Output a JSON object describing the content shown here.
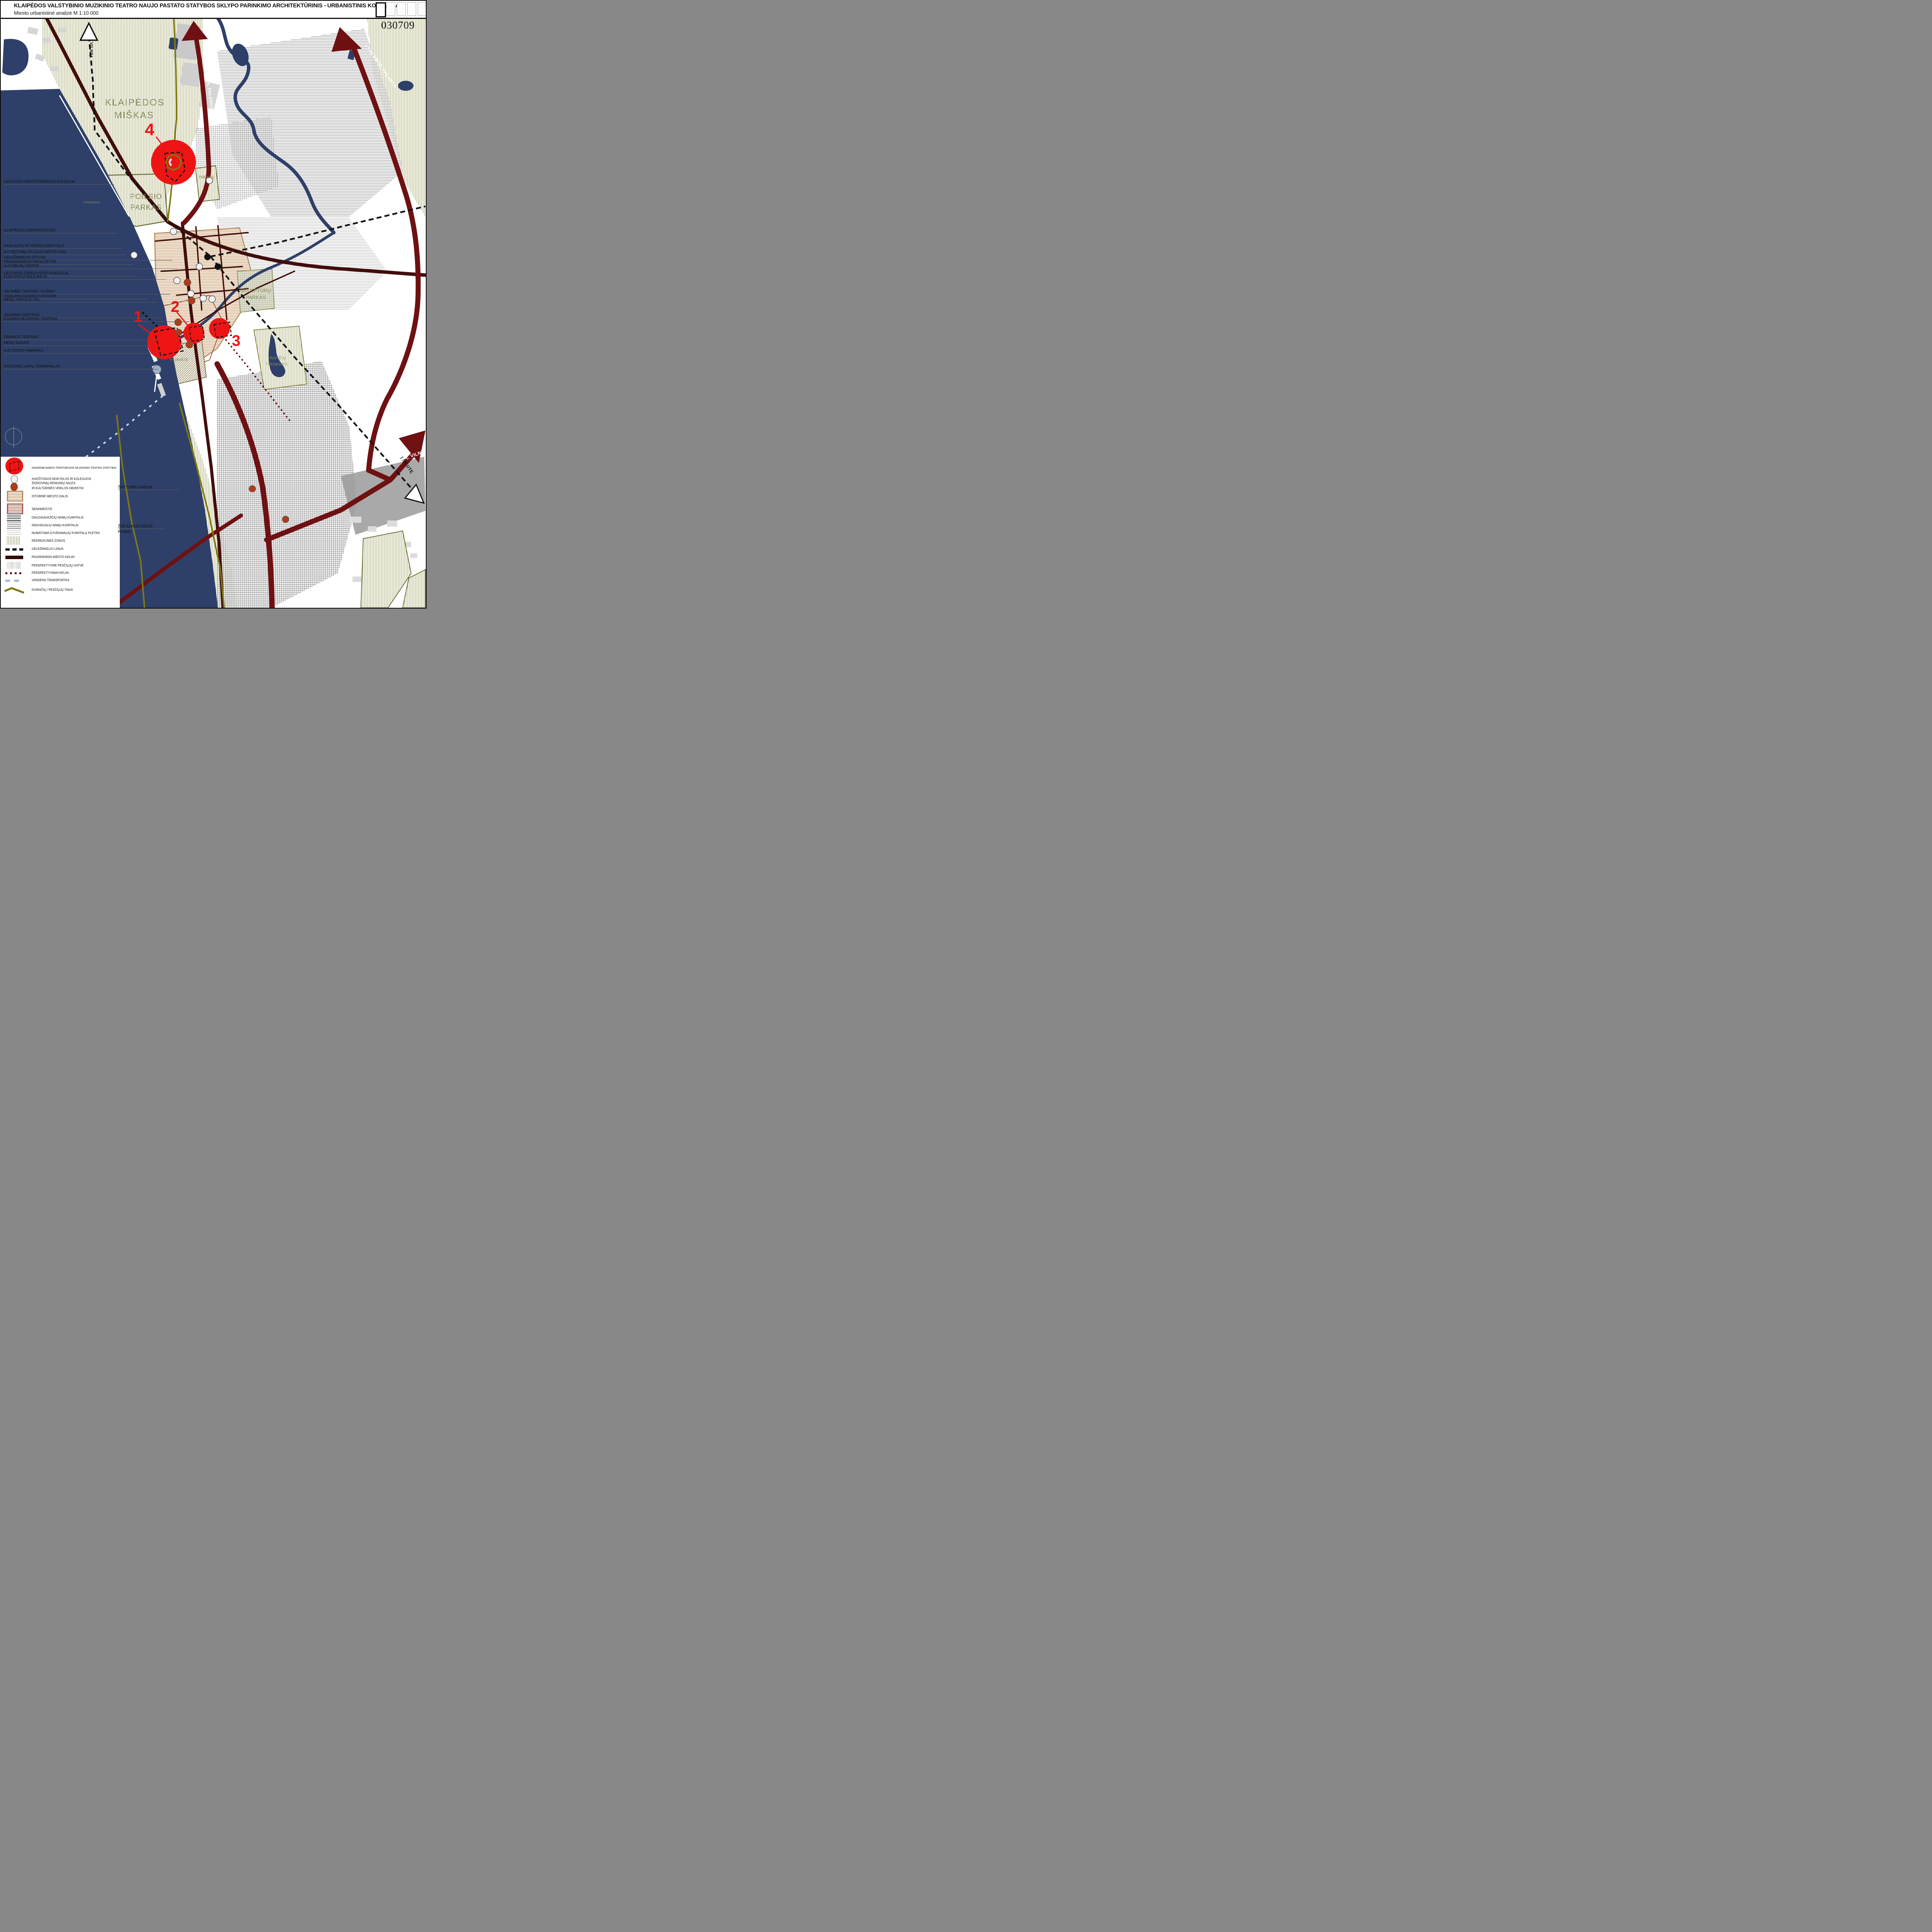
{
  "header": {
    "title": "KLAIPĖDOS VALSTYBINIO MUZIKINIO TEATRO NAUJO PASTATO STATYBOS SKLYPO PARINKIMO  ARCHITEKTŪRINIS - URBANISTINIS KONKURSAS",
    "subtitle": "Miesto urbanistinė analizė M 1:10 000",
    "sheet_code": "030709"
  },
  "compass_north": "Š",
  "road_labels": {
    "to_vilnius": "Į VILNIŲ",
    "to_kretinga_palanga_1": "Į KRETINGĄ, PALANGĄ",
    "to_kretinga_palanga_2": "Į KRETINGĄ, PALANGĄ",
    "to_kaunas_vilnius": "Į KAUNĄ, VILNIŲ",
    "to_silute": "Į ŠILUTĘ"
  },
  "area_labels": {
    "forest_1": "KLAIPĖDOS",
    "forest_2": "MIŠKAS",
    "poilsio_1": "POILSIO",
    "poilsio_2": "PARKAS",
    "trekas": "TREKAS",
    "stadionas": "STADIONAS",
    "skulpturu_1": "SKULPTŪRŲ",
    "skulpturu_2": "PARKAS",
    "trinyciu_1": "TRINYČIŲ",
    "trinyciu_2": "TVENKINYS",
    "piliaviete": "PILIAVIETĖ",
    "svyturio_arena": "ŠVYTURIO ARENA",
    "zveju_1": "ŽVEJŲ KULTŪROS",
    "zveju_2": "RŪMAI"
  },
  "site_markers": {
    "s1": "1",
    "s2": "2",
    "s3": "3",
    "s4": "4"
  },
  "left_labels": [
    "LIETUVOS KRIKŠČIONIŠKOJI KOLEGIJA",
    "KLAIPĖDOS UNIVERSITETAS",
    "PASLAUGŲ IR VERSLO MOKYKLA",
    "KU TĘSTINIŲ STUDIJU INSTITUTAS",
    "GELEŽINKELIO STOTIS",
    "PEDAGOGIKOS FAKULTETAS",
    "AUTOBUSŲ STOTIS",
    "LIETUVOS JŪREIVYSTĖS KOLEGIJA",
    "KONCERTŲ SALĖ 600 vt.",
    "JAUNIMO TEATRAS \"AUŠRA\"",
    "VIZALINIO DIZAINO KATEDRA",
    "MENŲ FAKULTETAS",
    "JAUNIMO CENTRAS",
    "ESAMAS MUZIKINIS TEATRAS",
    "DRAMOS TEATRAS",
    "MENŲ DOKAS",
    "KULTŪROS FABRIKAS",
    "KRUIZINIŲ LAIVŲ TERMIINALAS"
  ],
  "legend": {
    "rows": [
      {
        "label": "NAGRINĖJAMOS TERITORIJOS MUZIKINIO TEATRO STATYBAI"
      },
      {
        "label": "AUKŠTOSIOS MOKYKLOS IR KOLEGIJOS"
      },
      {
        "label": "ŽIŪROVINIŲ RENGINIŲ SALĖS",
        "label2": "IR KULTŪRINĖS VEIKLOS OBJEKTAI"
      },
      {
        "label": "ISTORINĖ MIESTO DALIS"
      },
      {
        "label": "SENAMIESTIS"
      },
      {
        "label": "DAUGIAAUKŠČIŲ NAMŲ KVARTALAI"
      },
      {
        "label": "INDIVIDUALIŲ NAMŲ KVARTALAI"
      },
      {
        "label": "NUMATOMA GYVENAMŲJŲ KVARTALŲ PLĖTRA"
      },
      {
        "label": "REKREACINĖS ZONOS"
      },
      {
        "label": "GELEŽINKELIO LINIJA"
      },
      {
        "label": "PAGRINDINIAI MIESTO KELIAI"
      },
      {
        "label": "PERSPEKTYVINĖ PĖSČIŲJŲ GATVĖ"
      },
      {
        "label": "PERSPEKTYVINIAI KELIAI"
      },
      {
        "label": "VANDENS TRANSPORTAS"
      },
      {
        "label": "DVIRAČIŲ / PĖSČIŲJŲ TAKAI"
      }
    ]
  },
  "colors": {
    "site_red": "#EF1414",
    "road_main": "#6F1013",
    "road_dark": "#420D0B",
    "water": "#2E4069",
    "recreation_olive": "#8A8A4A",
    "hall_brown": "#B23A18",
    "historic_tan": "#B5895A",
    "oldtown_red": "#A05A48",
    "cruise_blue": "#9FB0CC"
  }
}
